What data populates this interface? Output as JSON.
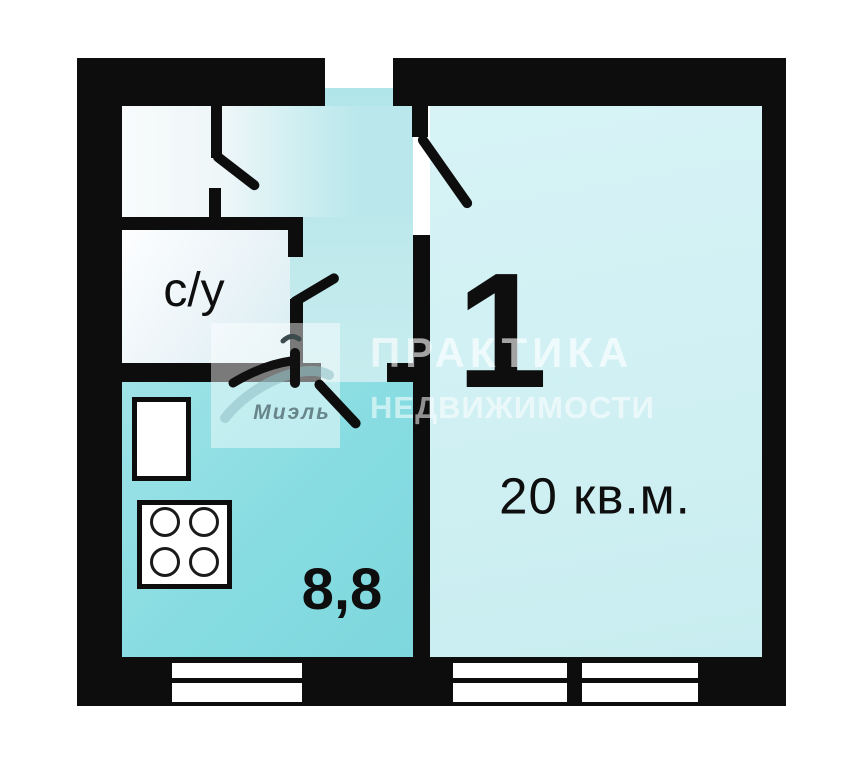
{
  "floor_plan": {
    "rooms": {
      "bathroom": {
        "label": "с/у"
      },
      "living_room": {
        "number": "1",
        "area": "20 кв.м."
      },
      "kitchen": {
        "area": "8,8"
      }
    },
    "watermark": {
      "line1": "ПРАКТИКА",
      "line2": "НЕДВИЖИМОСТИ",
      "agency": "Миэль"
    },
    "colors": {
      "wall": "#0d0d0d",
      "kitchen_fill": "#86dce1",
      "hallway_fill": "#bfe9ec",
      "living_room_fill": "#d0f0f3",
      "bathroom_fill": "#f2f8fa",
      "background": "#ffffff",
      "watermark_text": "#ffffff",
      "agency_text": "#587278"
    },
    "icons": {
      "stove": "stove-icon",
      "fridge": "fridge-icon",
      "window": "window-icon",
      "door": "door-swing-icon",
      "logo": "miel-logo-icon"
    }
  }
}
